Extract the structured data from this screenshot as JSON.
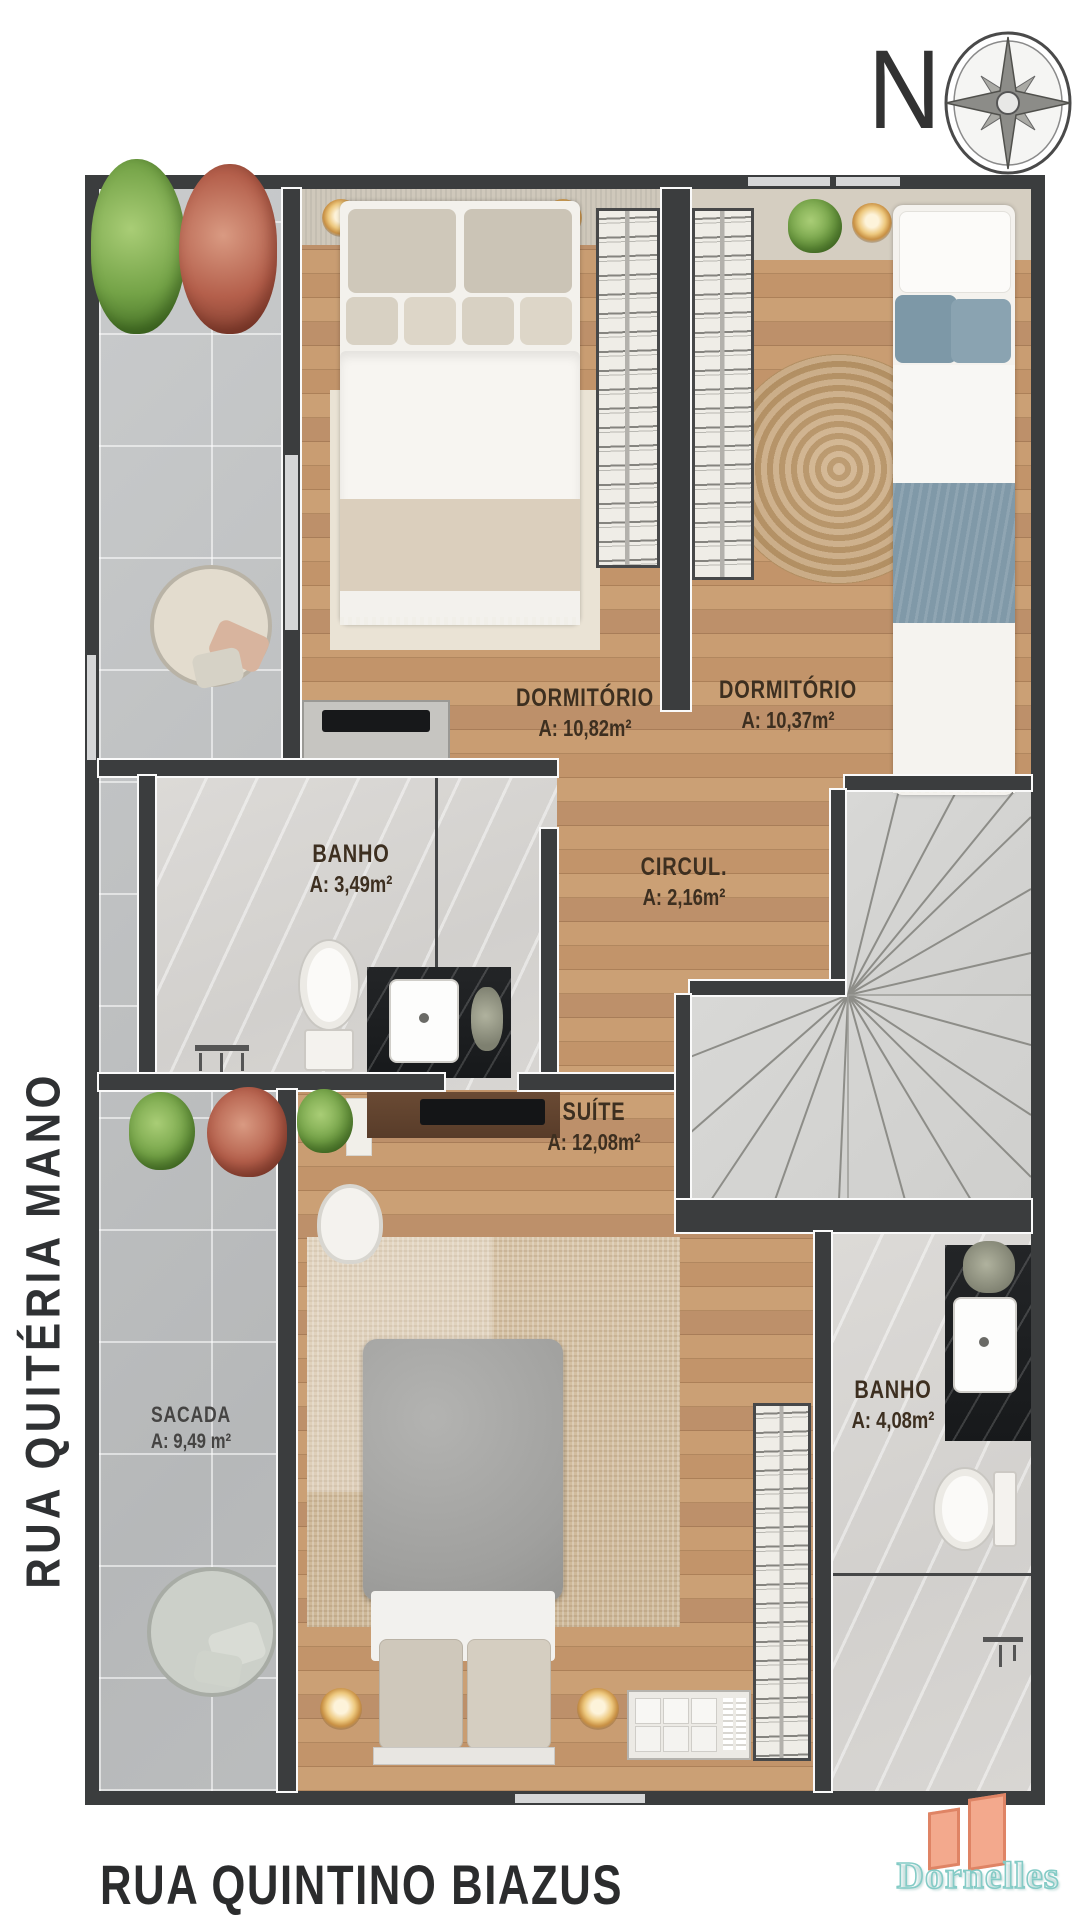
{
  "compass": {
    "north_label": "N"
  },
  "streets": {
    "left": "RUA QUITÉRIA MANO",
    "bottom": "RUA QUINTINO BIAZUS"
  },
  "rooms": {
    "dormitorio1": {
      "name": "DORMITÓRIO",
      "area": "A: 10,82m²"
    },
    "dormitorio2": {
      "name": "DORMITÓRIO",
      "area": "A: 10,37m²"
    },
    "banho1": {
      "name": "BANHO",
      "area": "A: 3,49m²"
    },
    "circulacao": {
      "name": "CIRCUL.",
      "area": "A: 2,16m²"
    },
    "suite": {
      "name": "SUÍTE",
      "area": "A: 12,08m²"
    },
    "banho2": {
      "name": "BANHO",
      "area": "A: 4,08m²"
    },
    "sacada": {
      "name": "SACADA",
      "area": "A: 9,49 m²"
    }
  },
  "logo": {
    "brand": "Dornelles"
  },
  "colors": {
    "wall": "#3b3d3e",
    "wood_floor": "#c59a6f",
    "tile_floor": "#c3c5c6",
    "marble_floor": "#d8d6d3",
    "stairs_floor": "#d4d4d2",
    "bedding_blue": "#7e99a8",
    "sconce_gold": "#dfae5a",
    "logo_buildings": "#f3a98d",
    "logo_text_outline": "#84cbc6"
  }
}
